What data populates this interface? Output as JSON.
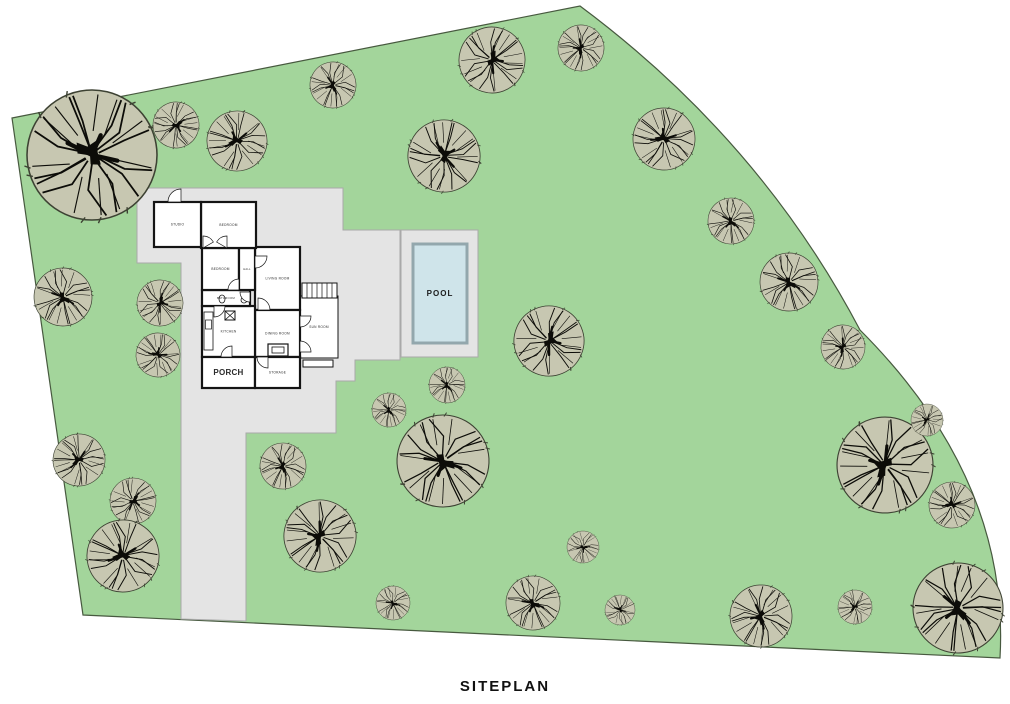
{
  "title": "SITEPLAN",
  "pool": {
    "label": "POOL"
  },
  "colors": {
    "site_green": "#a3d59b",
    "site_outline": "#47593f",
    "pad_gray": "#e4e4e4",
    "pad_outline": "#a9a9a9",
    "pool_water": "#cfe4ea",
    "pool_border": "#93a7ad",
    "tree_fill": "#c7c7b1",
    "tree_outline": "#3d4233",
    "branch": "#0c0c08",
    "wall": "#141414",
    "label": "#2b2b2b"
  },
  "house": {
    "rooms": [
      {
        "id": "sun-room",
        "label": "SUN ROOM",
        "x": 300,
        "y": 296,
        "w": 38,
        "h": 62,
        "fs": 3.2,
        "thin": true
      },
      {
        "id": "living-room",
        "label": "LIVING ROOM",
        "x": 255,
        "y": 247,
        "w": 45,
        "h": 63,
        "fs": 3.2
      },
      {
        "id": "dining-room",
        "label": "DINING ROOM",
        "x": 255,
        "y": 310,
        "w": 45,
        "h": 47,
        "fs": 3.2
      },
      {
        "id": "kitchen",
        "label": "KITCHEN",
        "x": 202,
        "y": 306,
        "w": 53,
        "h": 51,
        "fs": 3.2
      },
      {
        "id": "bathroom",
        "label": "BATHROOM",
        "x": 202,
        "y": 290,
        "w": 48,
        "h": 16,
        "fs": 2.8
      },
      {
        "id": "bedroom-2",
        "label": "BEDROOM",
        "x": 202,
        "y": 248,
        "w": 37,
        "h": 42,
        "fs": 3.2
      },
      {
        "id": "hall",
        "label": "HALL",
        "x": 239,
        "y": 248,
        "w": 16,
        "h": 42,
        "fs": 2.6
      },
      {
        "id": "bedroom-1",
        "label": "BEDROOM",
        "x": 201,
        "y": 202,
        "w": 55,
        "h": 46,
        "fs": 3.2
      },
      {
        "id": "studio",
        "label": "STUDIO",
        "x": 154,
        "y": 202,
        "w": 47,
        "h": 45,
        "fs": 3.2
      },
      {
        "id": "porch",
        "label": "PORCH",
        "x": 202,
        "y": 357,
        "w": 53,
        "h": 31,
        "fs": 8,
        "bold": true
      },
      {
        "id": "storage",
        "label": "STORAGE",
        "x": 255,
        "y": 357,
        "w": 45,
        "h": 31,
        "fs": 3.2
      }
    ]
  },
  "site": {
    "trees": [
      {
        "x": 92,
        "y": 155,
        "r": 65
      },
      {
        "x": 176,
        "y": 125,
        "r": 23
      },
      {
        "x": 237,
        "y": 141,
        "r": 30
      },
      {
        "x": 333,
        "y": 85,
        "r": 23
      },
      {
        "x": 444,
        "y": 156,
        "r": 36
      },
      {
        "x": 492,
        "y": 60,
        "r": 33
      },
      {
        "x": 581,
        "y": 48,
        "r": 23
      },
      {
        "x": 664,
        "y": 139,
        "r": 31
      },
      {
        "x": 731,
        "y": 221,
        "r": 23
      },
      {
        "x": 789,
        "y": 282,
        "r": 29
      },
      {
        "x": 843,
        "y": 347,
        "r": 22
      },
      {
        "x": 63,
        "y": 297,
        "r": 29
      },
      {
        "x": 160,
        "y": 303,
        "r": 23
      },
      {
        "x": 158,
        "y": 355,
        "r": 22
      },
      {
        "x": 79,
        "y": 460,
        "r": 26
      },
      {
        "x": 133,
        "y": 501,
        "r": 23
      },
      {
        "x": 123,
        "y": 556,
        "r": 36
      },
      {
        "x": 283,
        "y": 466,
        "r": 23
      },
      {
        "x": 320,
        "y": 536,
        "r": 36
      },
      {
        "x": 389,
        "y": 410,
        "r": 17
      },
      {
        "x": 447,
        "y": 385,
        "r": 18
      },
      {
        "x": 443,
        "y": 461,
        "r": 46
      },
      {
        "x": 549,
        "y": 341,
        "r": 35
      },
      {
        "x": 583,
        "y": 547,
        "r": 16
      },
      {
        "x": 533,
        "y": 603,
        "r": 27
      },
      {
        "x": 393,
        "y": 603,
        "r": 17
      },
      {
        "x": 620,
        "y": 610,
        "r": 15
      },
      {
        "x": 761,
        "y": 616,
        "r": 31
      },
      {
        "x": 855,
        "y": 607,
        "r": 17
      },
      {
        "x": 885,
        "y": 465,
        "r": 48
      },
      {
        "x": 927,
        "y": 420,
        "r": 16
      },
      {
        "x": 952,
        "y": 505,
        "r": 23
      },
      {
        "x": 958,
        "y": 608,
        "r": 45
      }
    ]
  }
}
